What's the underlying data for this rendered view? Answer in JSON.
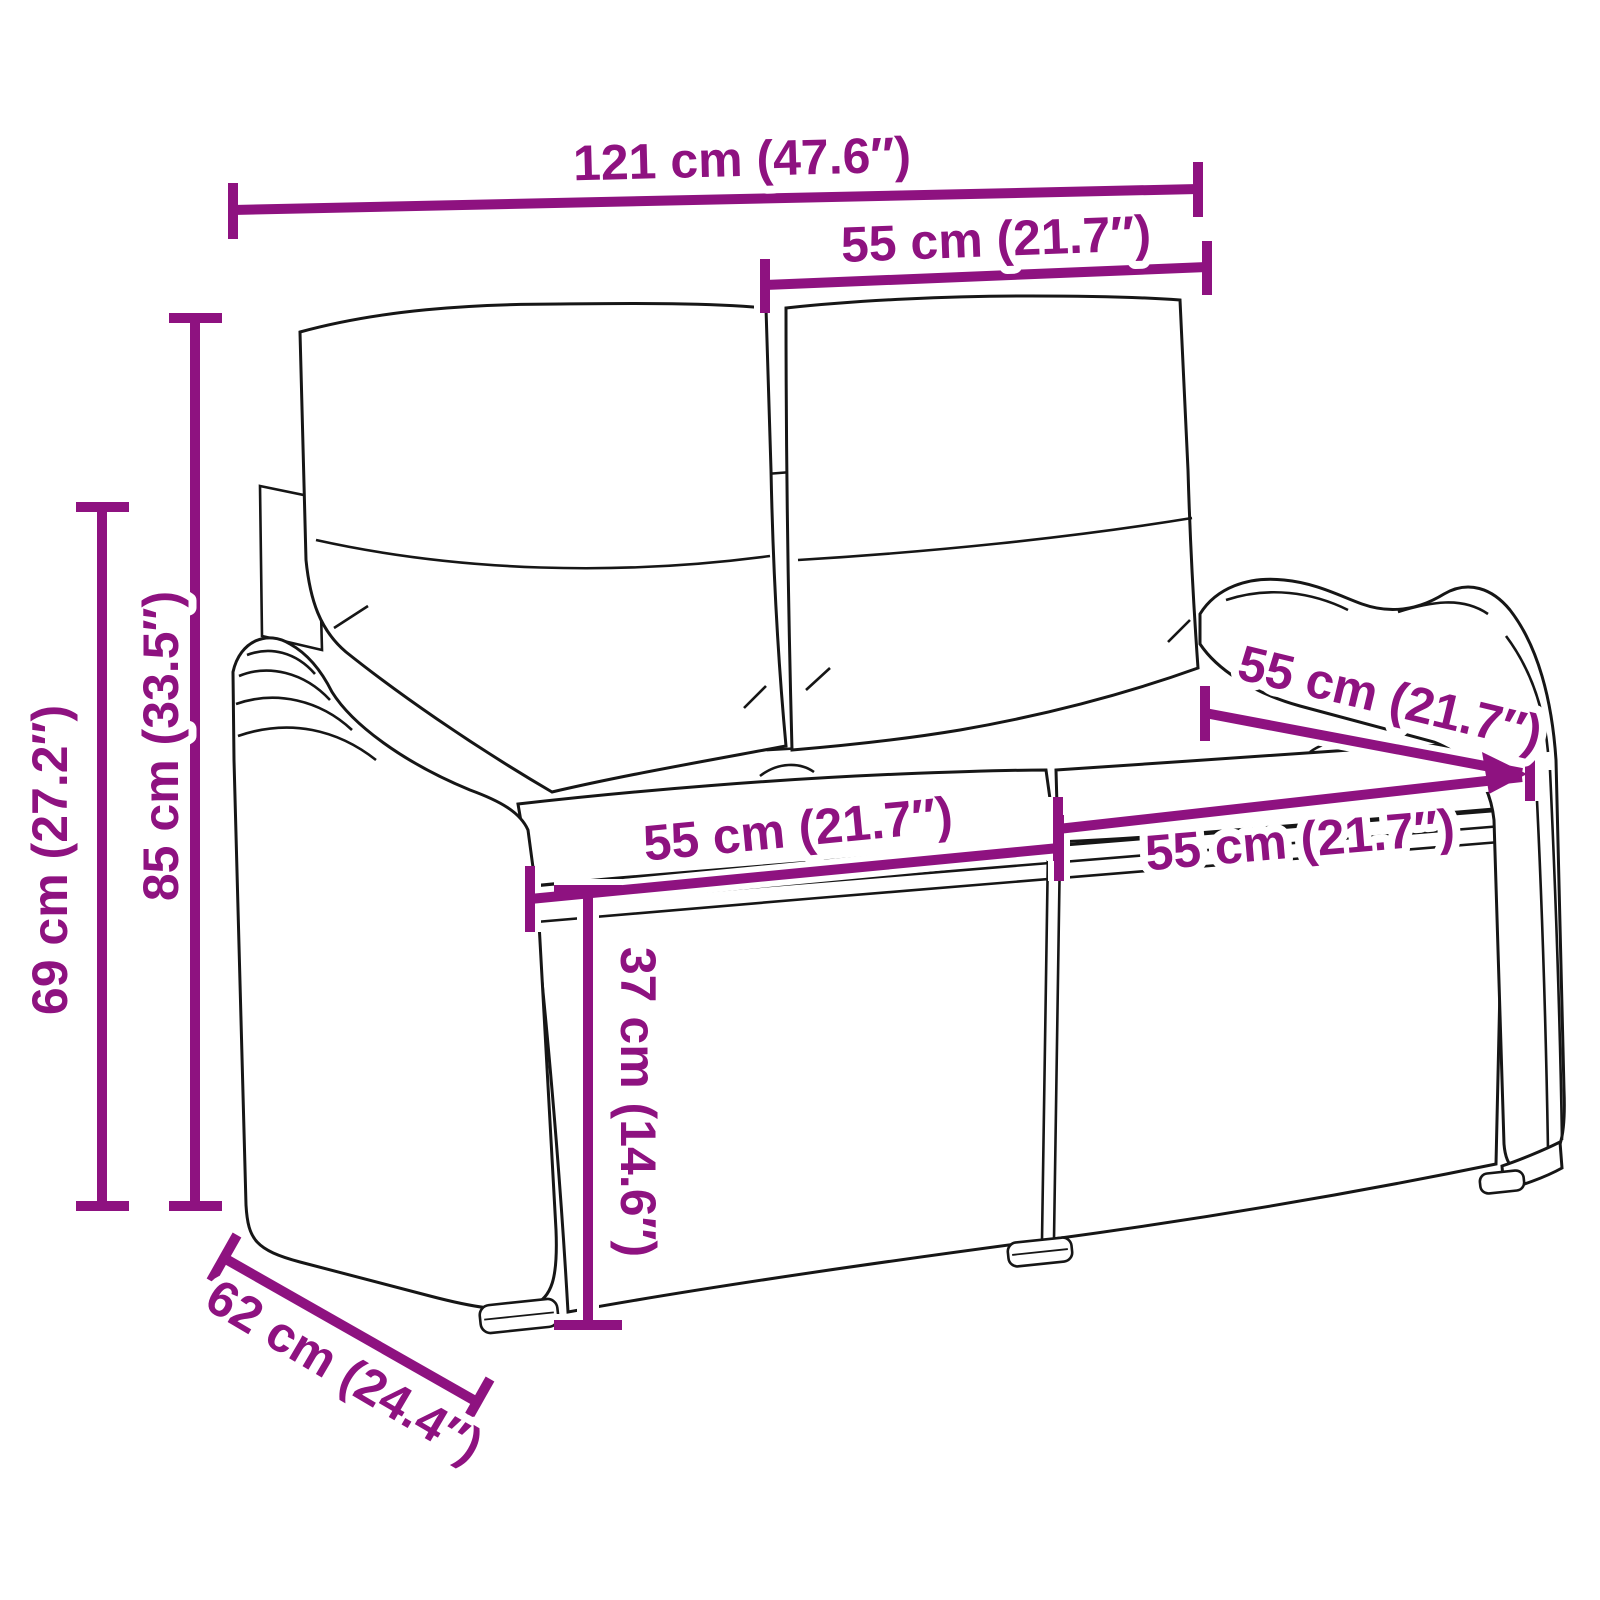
{
  "diagram": {
    "background": "#ffffff",
    "annotation_color": "#8E1280",
    "sketch_color": "#161616",
    "labels": {
      "total_width": "121 cm (47.6″)",
      "back_cushion_width": "55 cm (21.7″)",
      "total_height": "85 cm (33.5″)",
      "arm_height": "69 cm (27.2″)",
      "seat_width_left": "55 cm (21.7″)",
      "seat_width_right": "55 cm (21.7″)",
      "seat_depth": "55 cm (21.7″)",
      "seat_height": "37 cm (14.6″)",
      "total_depth": "62 cm (24.4″)"
    }
  }
}
